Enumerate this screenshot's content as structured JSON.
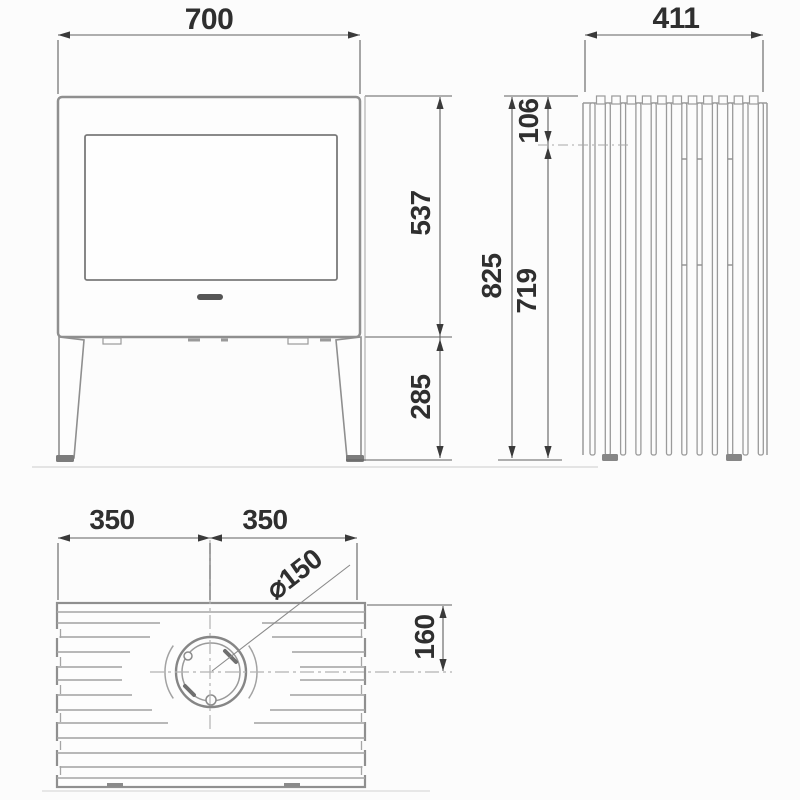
{
  "views": {
    "front": {
      "width": "700",
      "body_height": "537",
      "leg_height": "285"
    },
    "side": {
      "depth": "411",
      "top_offset": "106",
      "total_height": "825",
      "lower_height": "719"
    },
    "top": {
      "left_half": "350",
      "right_half": "350",
      "flue_diameter": "⌀150",
      "flue_offset": "160"
    }
  },
  "colors": {
    "dimension_line": "#5f5f5f",
    "dimension_text": "#2f2f2f",
    "object_line": "#8f8f8f",
    "background": "#fcfcfc"
  }
}
